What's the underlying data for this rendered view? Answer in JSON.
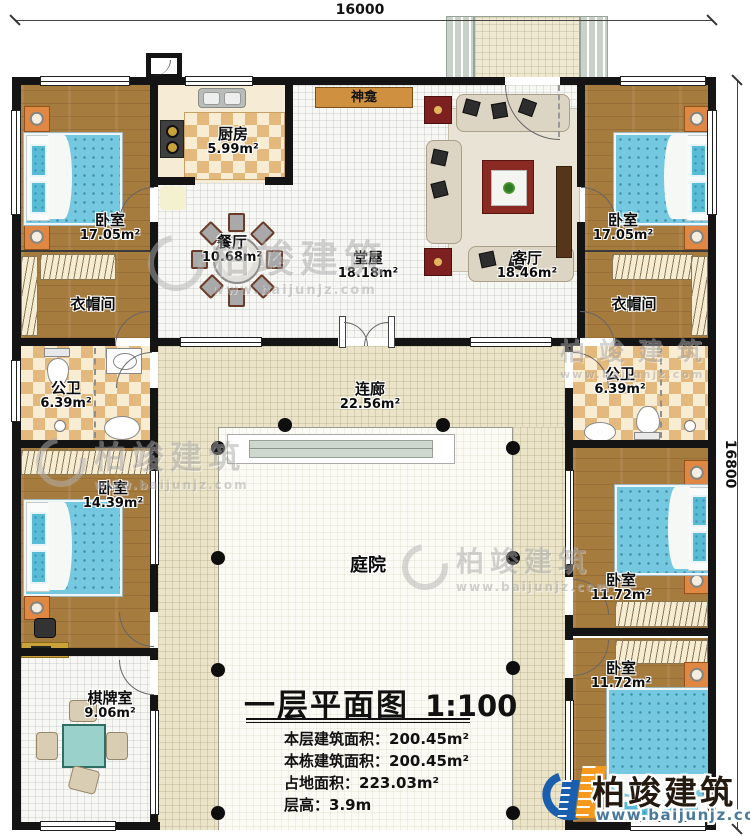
{
  "dimensions": {
    "top": "16000",
    "right": "16800"
  },
  "rooms": {
    "bedroom_tl": {
      "name": "卧室",
      "area": "17.05m²"
    },
    "bedroom_tr": {
      "name": "卧室",
      "area": "17.05m²"
    },
    "kitchen": {
      "name": "厨房",
      "area": "5.99m²"
    },
    "dining": {
      "name": "餐厅",
      "area": "10.68m²"
    },
    "hall": {
      "name": "堂屋",
      "area": "18.18m²"
    },
    "living": {
      "name": "客厅",
      "area": "18.46m²"
    },
    "shrine": {
      "name": "神龛"
    },
    "cloak_left": {
      "name": "衣帽间"
    },
    "cloak_right": {
      "name": "衣帽间"
    },
    "bath_left": {
      "name": "公卫",
      "area": "6.39m²"
    },
    "bath_right": {
      "name": "公卫",
      "area": "6.39m²"
    },
    "bedroom_ml": {
      "name": "卧室",
      "area": "14.39m²"
    },
    "bedroom_mr": {
      "name": "卧室",
      "area": "11.72m²"
    },
    "bedroom_br": {
      "name": "卧室",
      "area": "11.72m²"
    },
    "chess": {
      "name": "棋牌室",
      "area": "9.06m²"
    },
    "corridor": {
      "name": "连廊",
      "area": "22.56m²"
    },
    "courtyard": {
      "name": "庭院"
    }
  },
  "title_block": {
    "title": "一层平面图",
    "scale": "1:100",
    "stats": [
      {
        "label": "本层建筑面积：",
        "value": "200.45m²"
      },
      {
        "label": "本栋建筑面积：",
        "value": "200.45m²"
      },
      {
        "label": "占地面积：",
        "value": "223.03m²"
      },
      {
        "label": "层高：",
        "value": "3.9m"
      }
    ]
  },
  "branding": {
    "company": "柏竣建筑",
    "website": "www.baijunjz.com"
  },
  "colors": {
    "wall": "#141414",
    "wood": "#a67b3e",
    "corridor": "#ebe4c8",
    "checker": "#e4b97e",
    "bed": "#74c9e0",
    "logo_blue": "#1a5fae",
    "logo_orange": "#f59a1e"
  }
}
